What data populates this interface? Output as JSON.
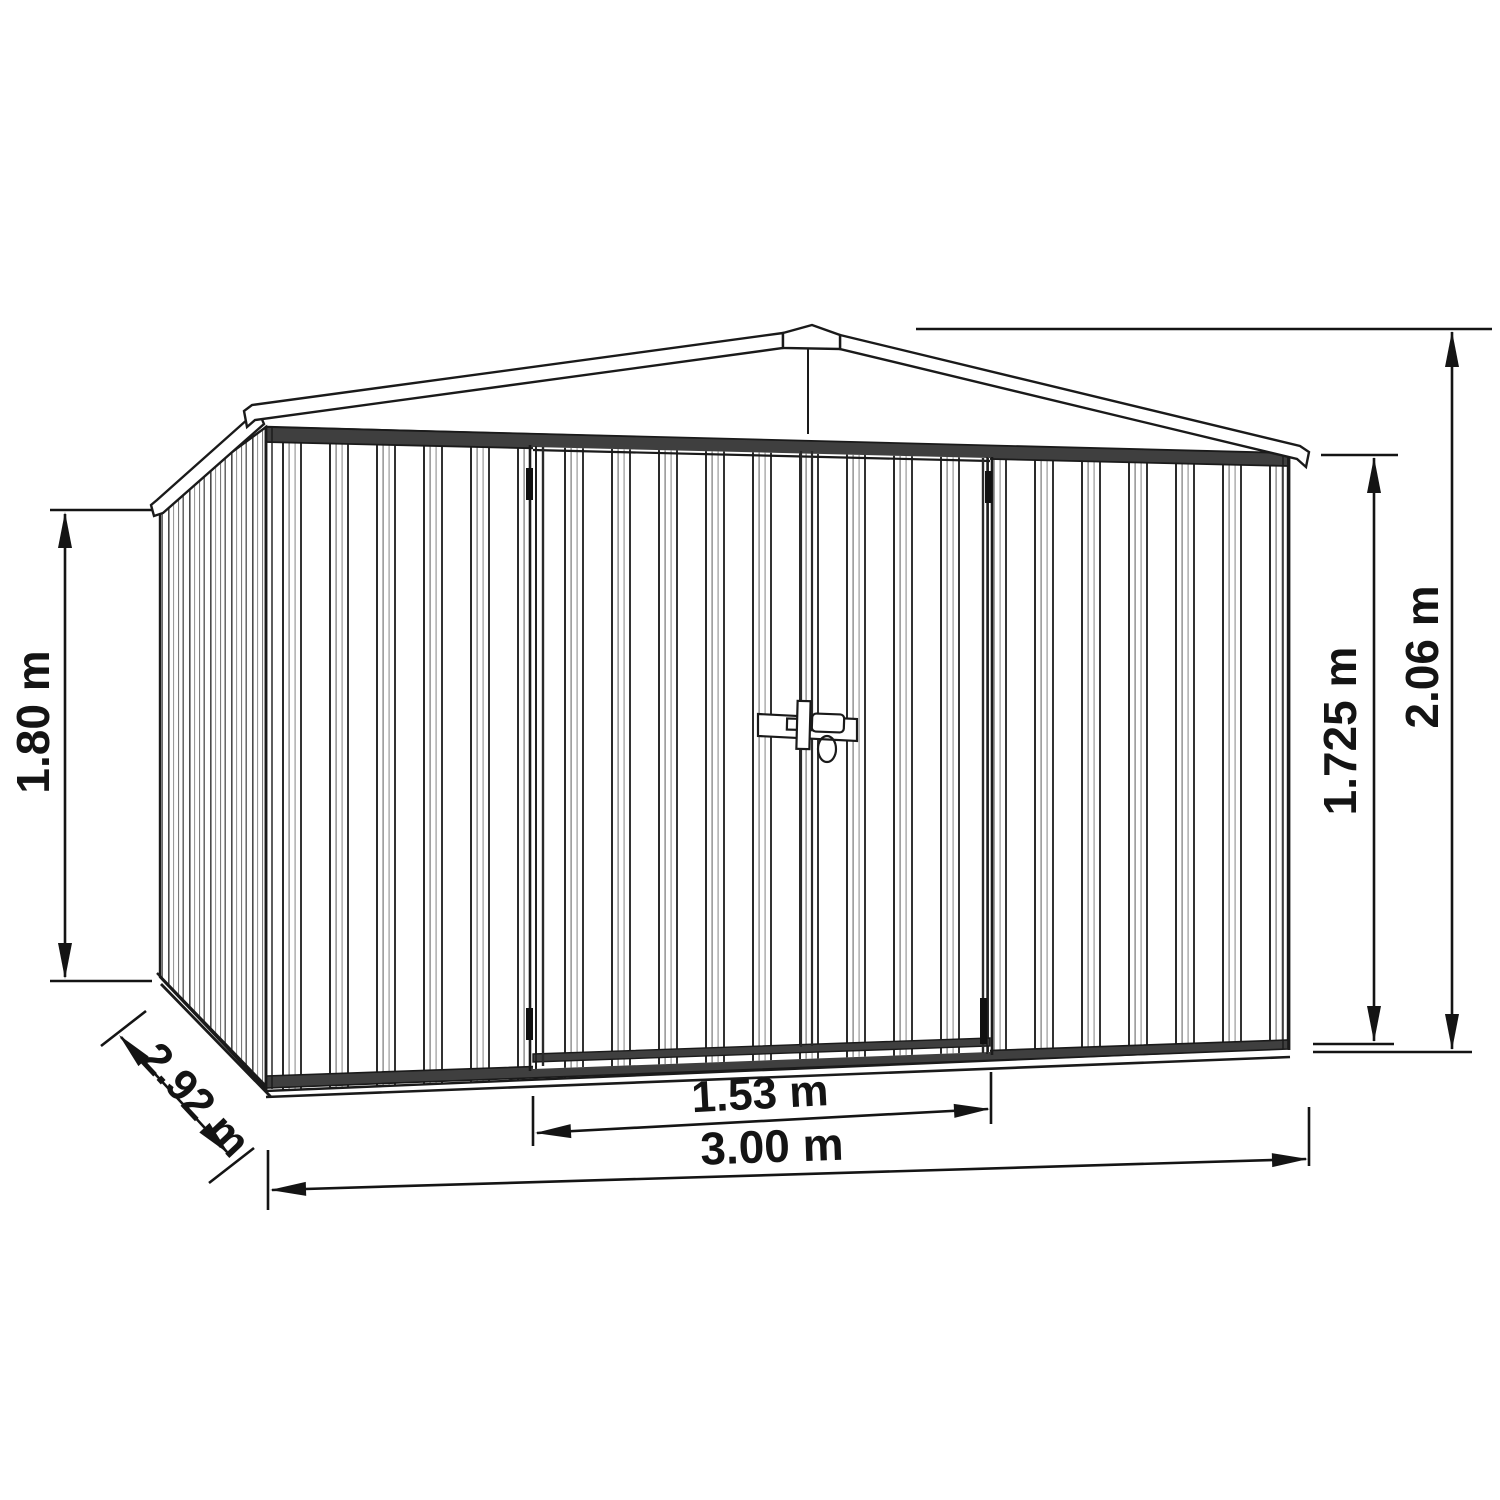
{
  "diagram": {
    "title": "garden-shed-dimension-drawing",
    "colors": {
      "line": "#1a1a1a",
      "background": "#ffffff",
      "band_fill": "#3f3f3f"
    },
    "dimensions": {
      "side_wall_height": "1.80 m",
      "depth": "2.92 m",
      "door_width": "1.53 m",
      "total_width": "3.00 m",
      "front_wall_height": "1.725 m",
      "ridge_height": "2.06 m"
    }
  }
}
